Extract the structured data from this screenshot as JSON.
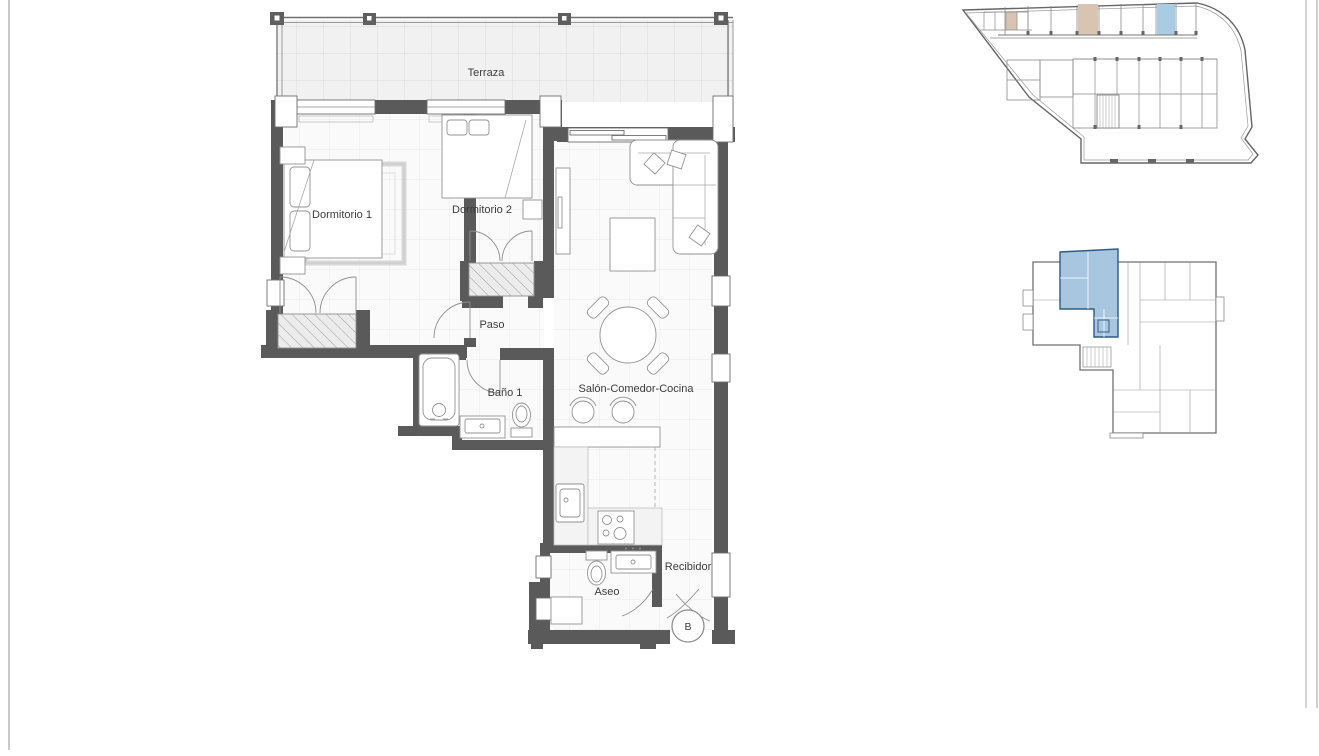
{
  "floor_plan": {
    "rooms": [
      {
        "label": "Terraza"
      },
      {
        "label": "Dormitorio 1"
      },
      {
        "label": "Dormitorio 2"
      },
      {
        "label": "Paso"
      },
      {
        "label": "Baño 1"
      },
      {
        "label": "Salón-Comedor-Cocina"
      },
      {
        "label": "Aseo"
      },
      {
        "label": "Recibidor"
      }
    ],
    "entrance_marker": "B"
  },
  "mini_plans": {
    "garage": {
      "highlighted_parking_color": "#a9cbe4",
      "highlighted_storage_color": "#d9c4b2"
    },
    "key_plan": {
      "highlighted_unit_color": "#a9c6e0",
      "highlighted_unit_border": "#2e5a86"
    }
  },
  "colors": {
    "wall": "#5a5a5a",
    "furniture_stroke": "#929292",
    "terrace_fill": "#f1f1f1",
    "terrace_grid": "#dadada",
    "room_fill": "#fafafa",
    "room_grid": "#e9e9e9",
    "frame_line": "#cfcfcf",
    "text": "#3c3c3c"
  }
}
